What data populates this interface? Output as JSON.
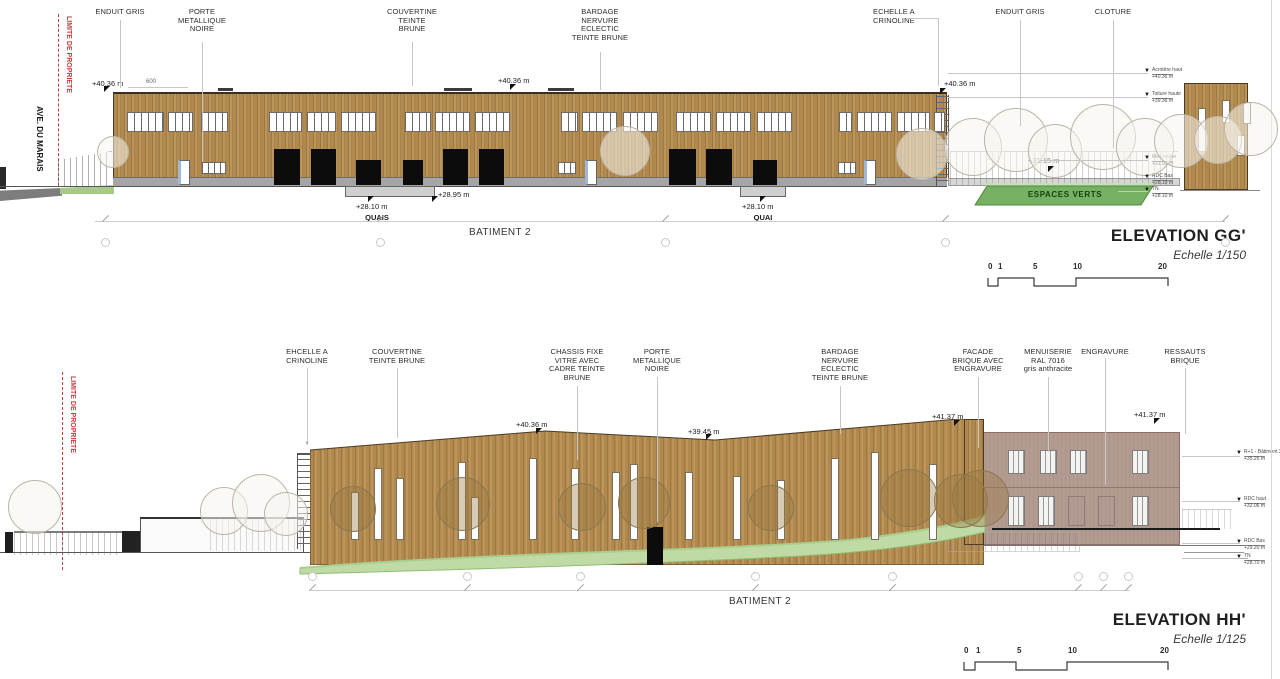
{
  "colors": {
    "bardage_brown": "#b1894f",
    "brick": "#b49b92",
    "green_band": "#76b062",
    "green_swoosh": "#c0daa5",
    "property_line_red": "#cc3a3a",
    "door_black": "#0c0c0c"
  },
  "gg": {
    "property_line": "LIMITE DE PROPRIETE",
    "street": "AVE. DU MARAIS",
    "callouts": [
      "ENDUIT GRIS",
      "PORTE\nMETALLIQUE\nNOIRE",
      "COUVERTINE\nTEINTE\nBRUNE",
      "BARDAGE\nNERVURE\nECLECTIC\nTEINTE BRUNE",
      "ECHELLE A\nCRINOLINE",
      "ENDUIT GRIS",
      "CLOTURE"
    ],
    "marks": {
      "left": "+40.36 m",
      "mid": "+40.36 m",
      "right": "+40.36 m",
      "terrace": "+31.15 m",
      "dim": "600"
    },
    "quays": [
      {
        "value": "+28.10 m",
        "label": "QUAIS"
      },
      {
        "value": "+28.95 m",
        "label": ""
      },
      {
        "value": "+28.10 m",
        "label": "QUAI"
      }
    ],
    "green_label": "ESPACES VERTS",
    "batiment": "BATIMENT 2",
    "title": "ELEVATION GG'",
    "scale": "Echelle 1/150",
    "ticks": [
      "0",
      "1",
      "5",
      "10",
      "20"
    ],
    "levels": [
      {
        "label": "Acrotère haut",
        "value": "+40.36 m"
      },
      {
        "label": "Toiture haute",
        "value": "+39.36 m"
      },
      {
        "label": "Mezzanine",
        "value": "+31.95 m"
      },
      {
        "label": "RDC Bas",
        "value": "+28.10 m"
      },
      {
        "label": "TN",
        "value": "+28.10 m"
      }
    ]
  },
  "hh": {
    "property_line": "LIMITE DE PROPRIETE",
    "callouts": [
      "EHCELLE A\nCRINOLINE",
      "COUVERTINE\nTEINTE BRUNE",
      "CHASSIS FIXE\nVITRE AVEC\nCADRE TEINTE\nBRUNE",
      "PORTE\nMETALLIQUE\nNOIRE",
      "BARDAGE\nNERVURE\nECLECTIC\nTEINTE BRUNE",
      "FACADE\nBRIQUE AVEC\nENGRAVURE",
      "MENUISERIE\nRAL 7016\ngris anthracite",
      "ENGRAVURE",
      "RESSAUTS\nBRIQUE"
    ],
    "marks": {
      "m1": "+40.36 m",
      "m2": "+39.45 m",
      "m3": "+41.37 m",
      "m4": "+41.37 m"
    },
    "batiment": "BATIMENT 2",
    "title": "ELEVATION HH'",
    "scale": "Echelle 1/125",
    "ticks": [
      "0",
      "1",
      "5",
      "10",
      "20"
    ],
    "levels": [
      {
        "label": "R+1 - Bâtiment 2",
        "value": "+35.26 m"
      },
      {
        "label": "RDC haut",
        "value": "+32.06 m"
      },
      {
        "label": "RDC Bas",
        "value": "+29.20 m"
      },
      {
        "label": "TN",
        "value": "+28.70 m"
      }
    ]
  }
}
